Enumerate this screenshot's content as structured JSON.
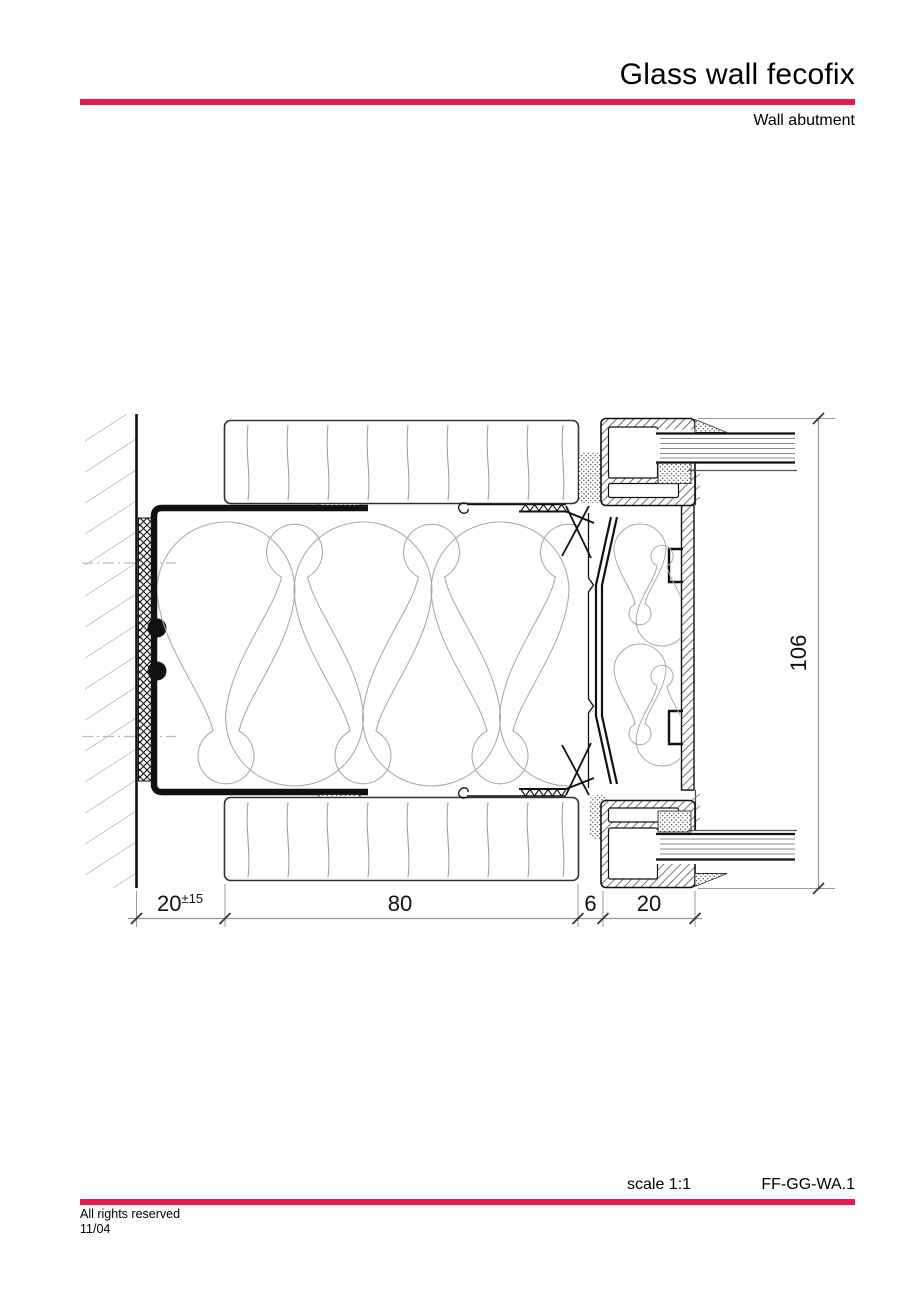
{
  "header": {
    "title": "Glass wall fecofix",
    "subtitle": "Wall abutment"
  },
  "footer": {
    "scale": "scale 1:1",
    "code": "FF-GG-WA.1",
    "rights": "All rights reserved",
    "date": "11/04"
  },
  "dims": {
    "offset": "20",
    "offset_tol": "±15",
    "width": "80",
    "joint": "6",
    "frame": "20",
    "height": "106"
  },
  "colors": {
    "accent": "#E9184C",
    "drawing_line": "#111111",
    "hatch_gray": "#999999",
    "insulation_gray": "#aaaaaa"
  }
}
